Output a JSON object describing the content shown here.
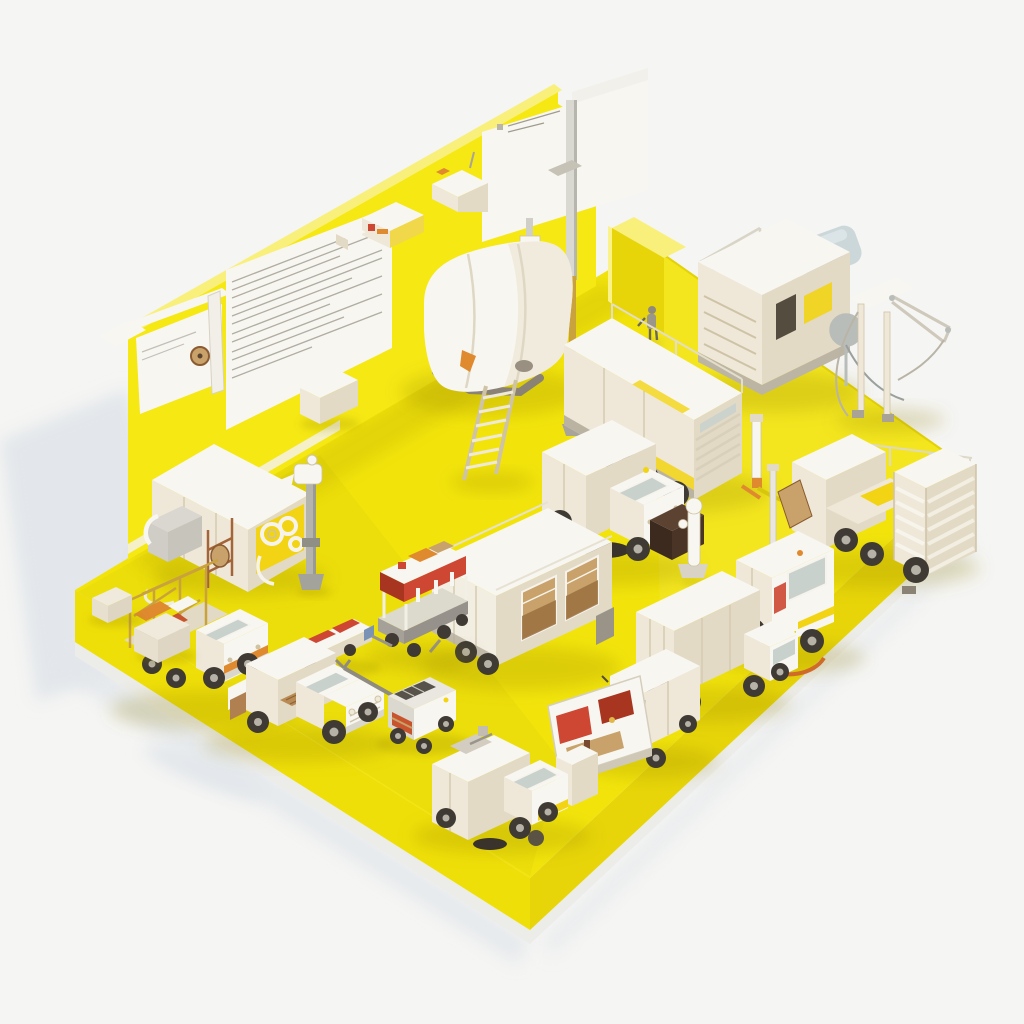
{
  "scene": {
    "description": "Isometric 3D miniature diorama: white and cream utility vehicles, trucks, tanks and depot equipment arranged on a bright yellow platform with a yellow back wall carrying white notice panels, a sign pole, a doorway and small machines on the wall ledge.",
    "objects": [
      {
        "id": "platform",
        "label": "yellow isometric platform"
      },
      {
        "id": "back-wall",
        "label": "yellow back wall"
      },
      {
        "id": "notice-board-left",
        "label": "white notice board with gauge"
      },
      {
        "id": "notice-panel-large",
        "label": "large white panel with fine text lines"
      },
      {
        "id": "sign-top",
        "label": "white sign panel at wall apex"
      },
      {
        "id": "sign-pole",
        "label": "sign pole"
      },
      {
        "id": "wall-top-machines",
        "label": "small machines on wall ledge"
      },
      {
        "id": "door-slab",
        "label": "yellow doorway slab"
      },
      {
        "id": "worker-figure",
        "label": "small worker figure"
      },
      {
        "id": "generator-cabinet",
        "label": "generator cabinet"
      },
      {
        "id": "street-lamp",
        "label": "street lamp with blue-grey head"
      },
      {
        "id": "hose-reel-derrick",
        "label": "derrick with cables"
      },
      {
        "id": "storage-tank",
        "label": "rounded white storage tank"
      },
      {
        "id": "ladder",
        "label": "leaning ladder"
      },
      {
        "id": "heavy-container-truck",
        "label": "multi-axle container truck"
      },
      {
        "id": "hose-cabinet",
        "label": "cabinet with coiled hoses"
      },
      {
        "id": "water-standpipe",
        "label": "standpipe with tap"
      },
      {
        "id": "sweeper-truck-center",
        "label": "sweeper truck with dark hopper"
      },
      {
        "id": "hydrant",
        "label": "white hydrant post"
      },
      {
        "id": "box-trailer",
        "label": "large box trailer with shelf windows"
      },
      {
        "id": "scissor-lift-cart",
        "label": "red and white scissor-lift cart"
      },
      {
        "id": "slat-container-truck",
        "label": "truck with slatted crate"
      },
      {
        "id": "service-van",
        "label": "service van with roof mast"
      },
      {
        "id": "box-truck",
        "label": "box truck"
      },
      {
        "id": "flatbed-small-truck",
        "label": "small cab truck"
      },
      {
        "id": "painted-panel",
        "label": "painted red and white panel"
      },
      {
        "id": "street-sweeper",
        "label": "street sweeper truck"
      },
      {
        "id": "pickup-truck",
        "label": "white pickup truck"
      },
      {
        "id": "cage-tow-truck",
        "label": "truck with open cage rack"
      },
      {
        "id": "concrete-blocks",
        "label": "concrete wedge blocks"
      },
      {
        "id": "barrier-trailer",
        "label": "low trailer with red rails"
      },
      {
        "id": "towbar-tug",
        "label": "tug with long drawbar"
      },
      {
        "id": "crate-by-wall",
        "label": "white crate near wall"
      }
    ]
  },
  "colors": {
    "background": "#f5f5f3",
    "backgroundShadow": "#e3e7eb",
    "platformTop": "#f2e40b",
    "platformFrontLeft": "#efdf08",
    "platformFrontRight": "#e7d509",
    "platformBase": "#ECECE8",
    "wallFace": "#f5e813",
    "wallTopHighlight": "#f9f07b",
    "floorShadow": "rgba(140,125,0,0.22)",
    "white": "#f8f6f1",
    "cream": "#efe8d8",
    "creamShade": "#e3dac5",
    "creamDark": "#cfc3a6",
    "panelLine": "#c9c2b0",
    "textLine": "#a09c90",
    "glass": "#c9d1cc",
    "dark": "#554c40",
    "wheel": "#3f3a33",
    "wheelHub": "#b7b2a7",
    "metal": "#b9bdb9",
    "orange": "#df8a2e",
    "red": "#cd4733",
    "darkRed": "#a8351f",
    "brown": "#5c4331",
    "tan": "#c8a26a",
    "accentYellow": "#f2d414",
    "lampHead": "#ccd7da",
    "poleGold": "#c9a23d"
  }
}
